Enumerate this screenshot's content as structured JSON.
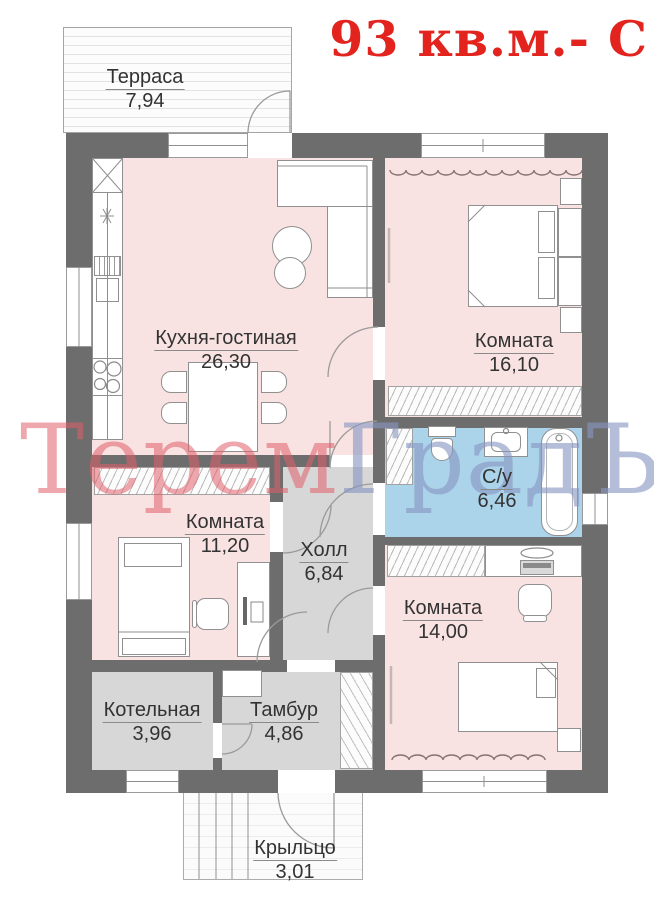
{
  "title": {
    "text": "93 кв.м.- С",
    "color": "#e2231e"
  },
  "watermark": {
    "part1": "Терем",
    "part2": "ГрадЪ",
    "color1": "#e05f67",
    "color2": "#8896c2"
  },
  "rooms": [
    {
      "id": "terrace",
      "name": "Терраса",
      "area": "7,94"
    },
    {
      "id": "kitchen",
      "name": "Кухня-гостиная",
      "area": "26,30"
    },
    {
      "id": "room16",
      "name": "Комната",
      "area": "16,10"
    },
    {
      "id": "bathroom",
      "name": "С/у",
      "area": "6,46"
    },
    {
      "id": "room11",
      "name": "Комната",
      "area": "11,20"
    },
    {
      "id": "hall",
      "name": "Холл",
      "area": "6,84"
    },
    {
      "id": "room14",
      "name": "Комната",
      "area": "14,00"
    },
    {
      "id": "boiler",
      "name": "Котельная",
      "area": "3,96"
    },
    {
      "id": "tambour",
      "name": "Тамбур",
      "area": "4,86"
    },
    {
      "id": "porch",
      "name": "Крыльцо",
      "area": "3,01"
    }
  ],
  "colors": {
    "wall": "#6e6d6e",
    "room_pink": "#f8e3e2",
    "service_gray": "#d8d7d8",
    "bathroom_blue": "#abd3e9",
    "plan_line": "#9a9a9a"
  }
}
